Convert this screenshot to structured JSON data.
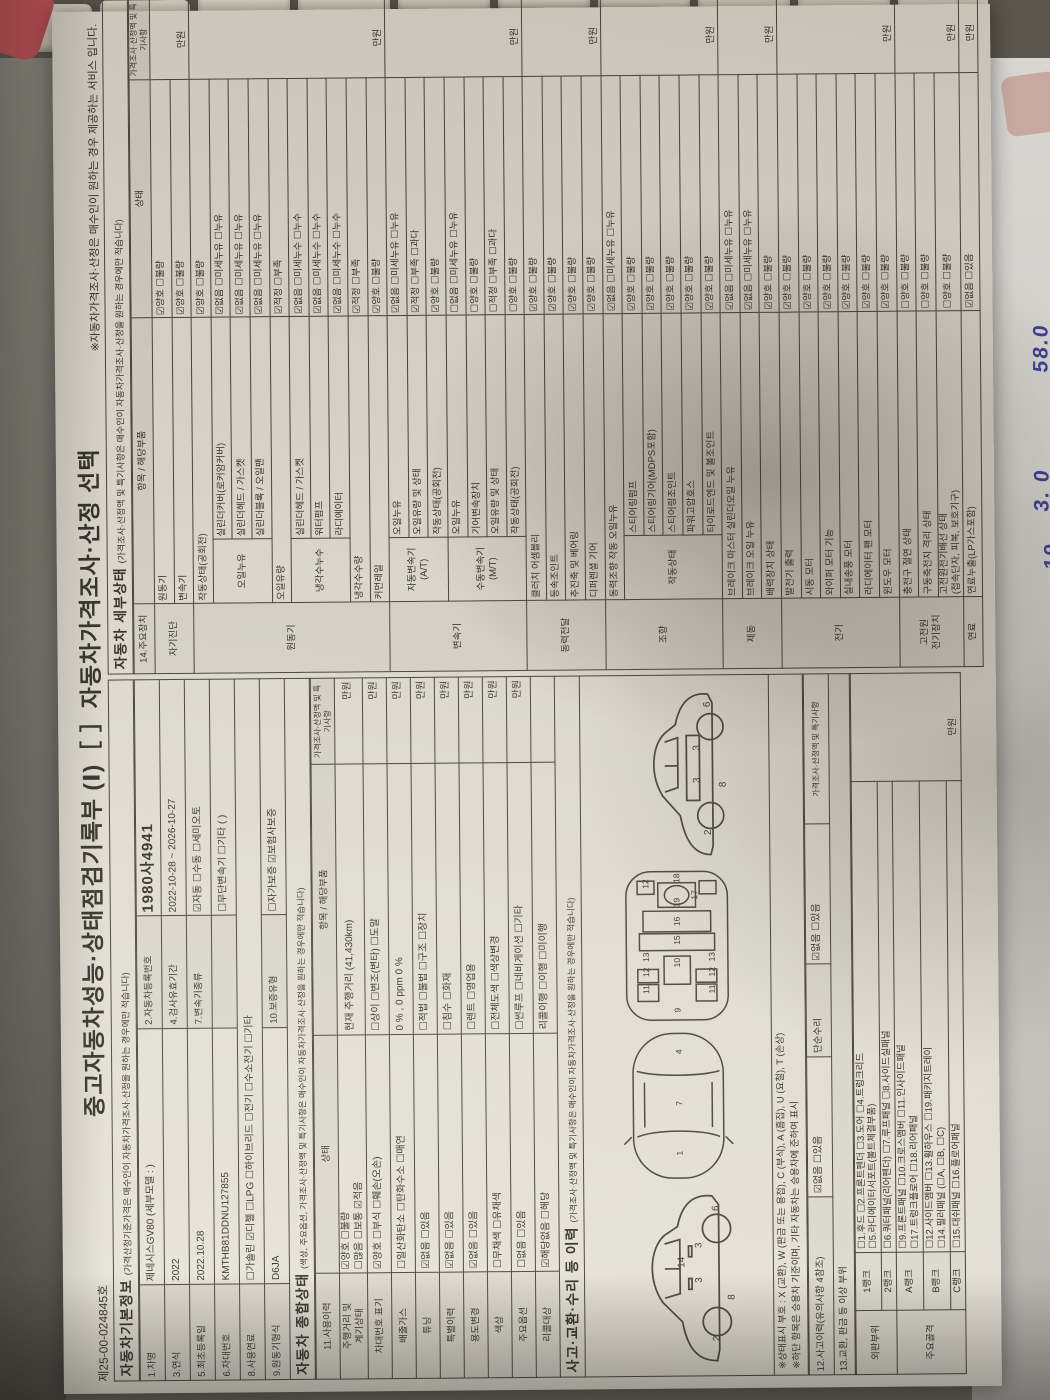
{
  "photo": {
    "handwriting": [
      "58.0",
      "56",
      "3. 0",
      "19.",
      "48",
      "26"
    ]
  },
  "doc": {
    "header": {
      "serial": "제25-00-024845호",
      "title": "중고자동차성능·상태점검기록부 (Ⅰ)［ ］자동차가격조사·산정 선택",
      "service_note": "※자동차가격조사·산정은 매수인이 원하는 경우 제공하는 서비스 입니다."
    },
    "basic_info": {
      "title": "자동차기본정보",
      "note": "(가격산정기준가격은 매수인이 자동차가격조사·산정을 원하는 경우에만 적습니다)",
      "rows": [
        [
          "1.차명",
          "제네시스GV80 (세부모델 : )",
          "2.자동차등록번호",
          "1980사4941"
        ],
        [
          "3.연식",
          "2022",
          "4.검사유효기간",
          "2022-10-28 ~ 2026-10-27"
        ],
        [
          "5.최초등록일",
          "2022.10.28",
          "7.변속기종류",
          "☑자동   ☐수동   ☐세미오토"
        ],
        [
          "6.차대번호",
          "KMTHB81DDNU127855",
          "",
          "☐무단변속기   ☐기타 (        )"
        ],
        [
          "8.사용연료",
          "☐가솔린  ☑디젤  ☐LPG  ☐하이브리드  ☐전기  ☐수소전기  ☐기타"
        ],
        [
          "9.원동기형식",
          "D6JA",
          "10.보증유형",
          "☐자가보증   ☑보험사보증"
        ]
      ]
    },
    "overall": {
      "title": "자동차 종합상태",
      "note": "(색상, 주요옵션, 가격조사·산정액 및 특기사항은 매수인이 자동차가격조사·산정을 원하는 경우에만 적습니다)",
      "col_label": "11.사용이력",
      "col_state": "상태",
      "col_item": "항목 / 해당부품",
      "col_price": "가격조사·산정액 및 특기사항",
      "rows": [
        {
          "label": "주행거리 및\n계기상태",
          "state": "☑양호  ☐불량\n☐많음  ☐보통  ☑적음",
          "item": "현재 주행거리 (41,430km)",
          "price": "만원"
        },
        {
          "label": "차대번호 표기",
          "state": "☑양호  ☐부식  ☐훼손(오손)",
          "item": "☐상이  ☐변조(변타)  ☐도말",
          "price": "만원"
        },
        {
          "label": "배출가스",
          "state": "☐일산화탄소 ☐탄화수소 ☐매연",
          "item": "0 % ,        0 ppm        0 %",
          "price": "만원"
        },
        {
          "label": "튜닝",
          "state": "☑없음  ☐있음",
          "item": "☐적법  ☐불법    ☐구조  ☐장치",
          "price": "만원"
        },
        {
          "label": "특별이력",
          "state": "☑없음  ☐있음",
          "item": "☐침수  ☐화재",
          "price": "만원"
        },
        {
          "label": "용도변경",
          "state": "☑없음  ☐있음",
          "item": "☐렌트  ☐영업용",
          "price": "만원"
        },
        {
          "label": "색상",
          "state": "☐무채색  ☐유채색",
          "item": "☐전체도색  ☐색상변경",
          "price": "만원"
        },
        {
          "label": "주요옵션",
          "state": "☐없음  ☐있음",
          "item": "☐썬루프  ☐네비게이션  ☐기타",
          "price": "만원"
        },
        {
          "label": "리콜대상",
          "state": "☑해당없음  ☐해당",
          "item": "리콜이행   ☐이행  ☐미이행",
          "price": ""
        }
      ]
    },
    "accident": {
      "title": "사고·교환·수리 등 이력",
      "note": "(가격조사·산정액 및 특기사항은 매수인이 자동차가격조사·산정을 원하는 경우에만 적습니다)",
      "marks_note": "※상태표시 부호 : X (교환), W (판금 또는 용접), C (부식), A (흠집), U (요철), T (손상)",
      "basis_note": "※하단 항목은 승용차 기준이며, 기타 자동차는 승용차에 준하여 표시",
      "row12_label": "12.사고이력(유의사항 4참조)",
      "row12_state": "☑없음   ☐있음",
      "simple_label": "단순수리",
      "simple_state": "☑없음   ☐있음",
      "price_head": "가격조사·산정액 및 특기사항",
      "row13_label": "13.교환, 판금 등 이상 부위",
      "price_unit": "만원",
      "groups": [
        {
          "zone": "외판부위",
          "ranks": [
            {
              "rank": "1랭크",
              "items": "☐1.후드  ☐2.프론트펜더  ☐3.도어  ☐4.트렁크리드\n☐5.라디에이터서포트(볼트체결부품)"
            },
            {
              "rank": "2랭크",
              "items": "☐6.쿼터패널(리어펜더)  ☐7.루프패널  ☐8.사이드실패널"
            }
          ]
        },
        {
          "zone": "주요골격",
          "ranks": [
            {
              "rank": "A랭크",
              "items": "☐9.프론트패널  ☐10.크로스멤버  ☐11.인사이드패널\n☐17.트렁크플로어  ☐18.리어패널"
            },
            {
              "rank": "B랭크",
              "items": "☐12.사이드멤버  ☐13.휠하우스  ☐19.패키지트레이\n☐14.필러패널 (☐A, ☐B, ☐C)"
            },
            {
              "rank": "C랭크",
              "items": "☐15.대쉬패널  ☐16.플로어패널"
            }
          ]
        }
      ]
    },
    "detail": {
      "title": "자동차 세부상태",
      "note": "(가격조사·산정액 및 특기사항은 매수인이 자동차가격조사·산정을 원하는 경우에만 적습니다)",
      "col_device": "14.주요장치",
      "col_item": "항목 / 해당부품",
      "col_state": "상태",
      "col_price": "가격조사·산정액 및 특기사항",
      "price_unit": "만원",
      "groups": [
        {
          "name": "자기진단",
          "rows": [
            {
              "item": "원동기",
              "state": "☑양호  ☐불량"
            },
            {
              "item": "변속기",
              "state": "☑양호  ☐불량"
            }
          ]
        },
        {
          "name": "원동기",
          "rows": [
            {
              "item": "작동상태(공회전)",
              "state": "☑양호  ☐불량"
            },
            {
              "sub": "오일누유",
              "span": 3,
              "item": "실린더커버(로커암커버)",
              "state": "☑없음  ☐미세누유  ☐누유"
            },
            {
              "item": "실린더헤드 / 가스켓",
              "state": "☑없음  ☐미세누유  ☐누유"
            },
            {
              "item": "실린더블록 / 오일팬",
              "state": "☑없음  ☐미세누유  ☐누유"
            },
            {
              "item": "오일유량",
              "state": "☑적정  ☐부족"
            },
            {
              "sub": "냉각수누수",
              "span": 3,
              "item": "실린더헤드 / 가스켓",
              "state": "☑없음  ☐미세누수  ☐누수"
            },
            {
              "item": "워터펌프",
              "state": "☑없음  ☐미세누수  ☐누수"
            },
            {
              "item": "라디에이터",
              "state": "☑없음  ☐미세누수  ☐누수"
            },
            {
              "item": "냉각수수량",
              "state": "☑적정  ☐부족"
            },
            {
              "item": "커먼레일",
              "state": "☑양호  ☐불량"
            }
          ]
        },
        {
          "name": "변속기",
          "rows": [
            {
              "sub": "자동변속기\n(A/T)",
              "span": 3,
              "item": "오일누유",
              "state": "☑없음  ☐미세누유  ☐누유"
            },
            {
              "item": "오일유량 및 상태",
              "state": "☑적정  ☐부족  ☐과다"
            },
            {
              "item": "작동상태(공회전)",
              "state": "☑양호  ☐불량"
            },
            {
              "sub": "수동변속기\n(M/T)",
              "span": 4,
              "item": "오일누유",
              "state": "☐없음  ☐미세누유  ☐누유"
            },
            {
              "item": "기어변속장치",
              "state": "☐양호  ☐불량"
            },
            {
              "item": "오일유량 및 상태",
              "state": "☐적정  ☐부족  ☐과다"
            },
            {
              "item": "작동상태(공회전)",
              "state": "☐양호  ☐불량"
            }
          ]
        },
        {
          "name": "동력전달",
          "rows": [
            {
              "item": "클러치 어셈블리",
              "state": "☑양호  ☐불량"
            },
            {
              "item": "등속조인트",
              "state": "☑양호  ☐불량"
            },
            {
              "item": "추진축 및 베어링",
              "state": "☑양호  ☐불량"
            },
            {
              "item": "디퍼렌셜 기어",
              "state": "☑양호  ☐불량"
            }
          ]
        },
        {
          "name": "조향",
          "rows": [
            {
              "item": "동력조향 작동 오일누유",
              "state": "☑없음  ☐미세누유  ☐누유"
            },
            {
              "sub": "작동상태",
              "span": 5,
              "item": "스티어링펌프",
              "state": "☑양호  ☐불량"
            },
            {
              "item": "스티어링기어(MDPS포함)",
              "state": "☑양호  ☐불량"
            },
            {
              "item": "스티어링조인트",
              "state": "☑양호  ☐불량"
            },
            {
              "item": "파워고압호스",
              "state": "☑양호  ☐불량"
            },
            {
              "item": "타이로드엔드 및 볼조인트",
              "state": "☑양호  ☐불량"
            }
          ]
        },
        {
          "name": "제동",
          "rows": [
            {
              "item": "브레이크 마스터 실린더오일 누유",
              "state": "☑없음  ☐미세누유  ☐누유"
            },
            {
              "item": "브레이크 오일 누유",
              "state": "☑없음  ☐미세누유  ☐누유"
            },
            {
              "item": "배력장치 상태",
              "state": "☑양호  ☐불량"
            }
          ]
        },
        {
          "name": "전기",
          "rows": [
            {
              "item": "발전기 출력",
              "state": "☑양호  ☐불량"
            },
            {
              "item": "시동 모터",
              "state": "☑양호  ☐불량"
            },
            {
              "item": "와이퍼 모터 기능",
              "state": "☑양호  ☐불량"
            },
            {
              "item": "실내송풍 모터",
              "state": "☑양호  ☐불량"
            },
            {
              "item": "라디에이터 팬 모터",
              "state": "☑양호  ☐불량"
            },
            {
              "item": "윈도우 모터",
              "state": "☑양호  ☐불량"
            }
          ]
        },
        {
          "name": "고전원\n전기장치",
          "rows": [
            {
              "item": "충전구 절연 상태",
              "state": "☐양호  ☐불량"
            },
            {
              "item": "구동축전지 격리 상태",
              "state": "☐양호  ☐불량"
            },
            {
              "item": "고전원전기배선 상태\n(접속단자, 피복, 보호기구)",
              "state": "☐양호  ☐불량"
            }
          ]
        },
        {
          "name": "연료",
          "rows": [
            {
              "item": "연료누출(LP가스포함)",
              "state": "☑없음  ☐있음"
            }
          ]
        }
      ]
    },
    "diagrams": {
      "side": {
        "labels": [
          {
            "t": "2",
            "x": 26,
            "y": 102
          },
          {
            "t": "8",
            "x": 64,
            "y": 116
          },
          {
            "t": "3",
            "x": 80,
            "y": 86
          },
          {
            "t": "3",
            "x": 112,
            "y": 86
          },
          {
            "t": "14",
            "x": 94,
            "y": 70
          },
          {
            "t": "6",
            "x": 146,
            "y": 102
          }
        ]
      },
      "top": {
        "labels": [
          {
            "t": "1",
            "x": 32,
            "y": 80
          },
          {
            "t": "7",
            "x": 85,
            "y": 80
          },
          {
            "t": "4",
            "x": 140,
            "y": 80
          }
        ]
      },
      "floor": {
        "labels": [
          {
            "t": "9",
            "x": 14,
            "y": 79
          },
          {
            "t": "11",
            "x": 34,
            "y": 46
          },
          {
            "t": "11",
            "x": 34,
            "y": 116
          },
          {
            "t": "12",
            "x": 52,
            "y": 46
          },
          {
            "t": "12",
            "x": 52,
            "y": 116
          },
          {
            "t": "13",
            "x": 68,
            "y": 46
          },
          {
            "t": "13",
            "x": 68,
            "y": 116
          },
          {
            "t": "10",
            "x": 62,
            "y": 79
          },
          {
            "t": "15",
            "x": 86,
            "y": 79
          },
          {
            "t": "16",
            "x": 106,
            "y": 79
          },
          {
            "t": "19",
            "x": 126,
            "y": 79
          },
          {
            "t": "17",
            "x": 134,
            "y": 98
          },
          {
            "t": "12",
            "x": 146,
            "y": 46
          },
          {
            "t": "18",
            "x": 152,
            "y": 79
          }
        ]
      },
      "frame": {
        "labels": [
          {
            "t": "2",
            "x": 28,
            "y": 98
          },
          {
            "t": "3",
            "x": 76,
            "y": 88
          },
          {
            "t": "3",
            "x": 106,
            "y": 88
          },
          {
            "t": "8",
            "x": 72,
            "y": 112
          },
          {
            "t": "6",
            "x": 146,
            "y": 98
          }
        ]
      }
    }
  }
}
